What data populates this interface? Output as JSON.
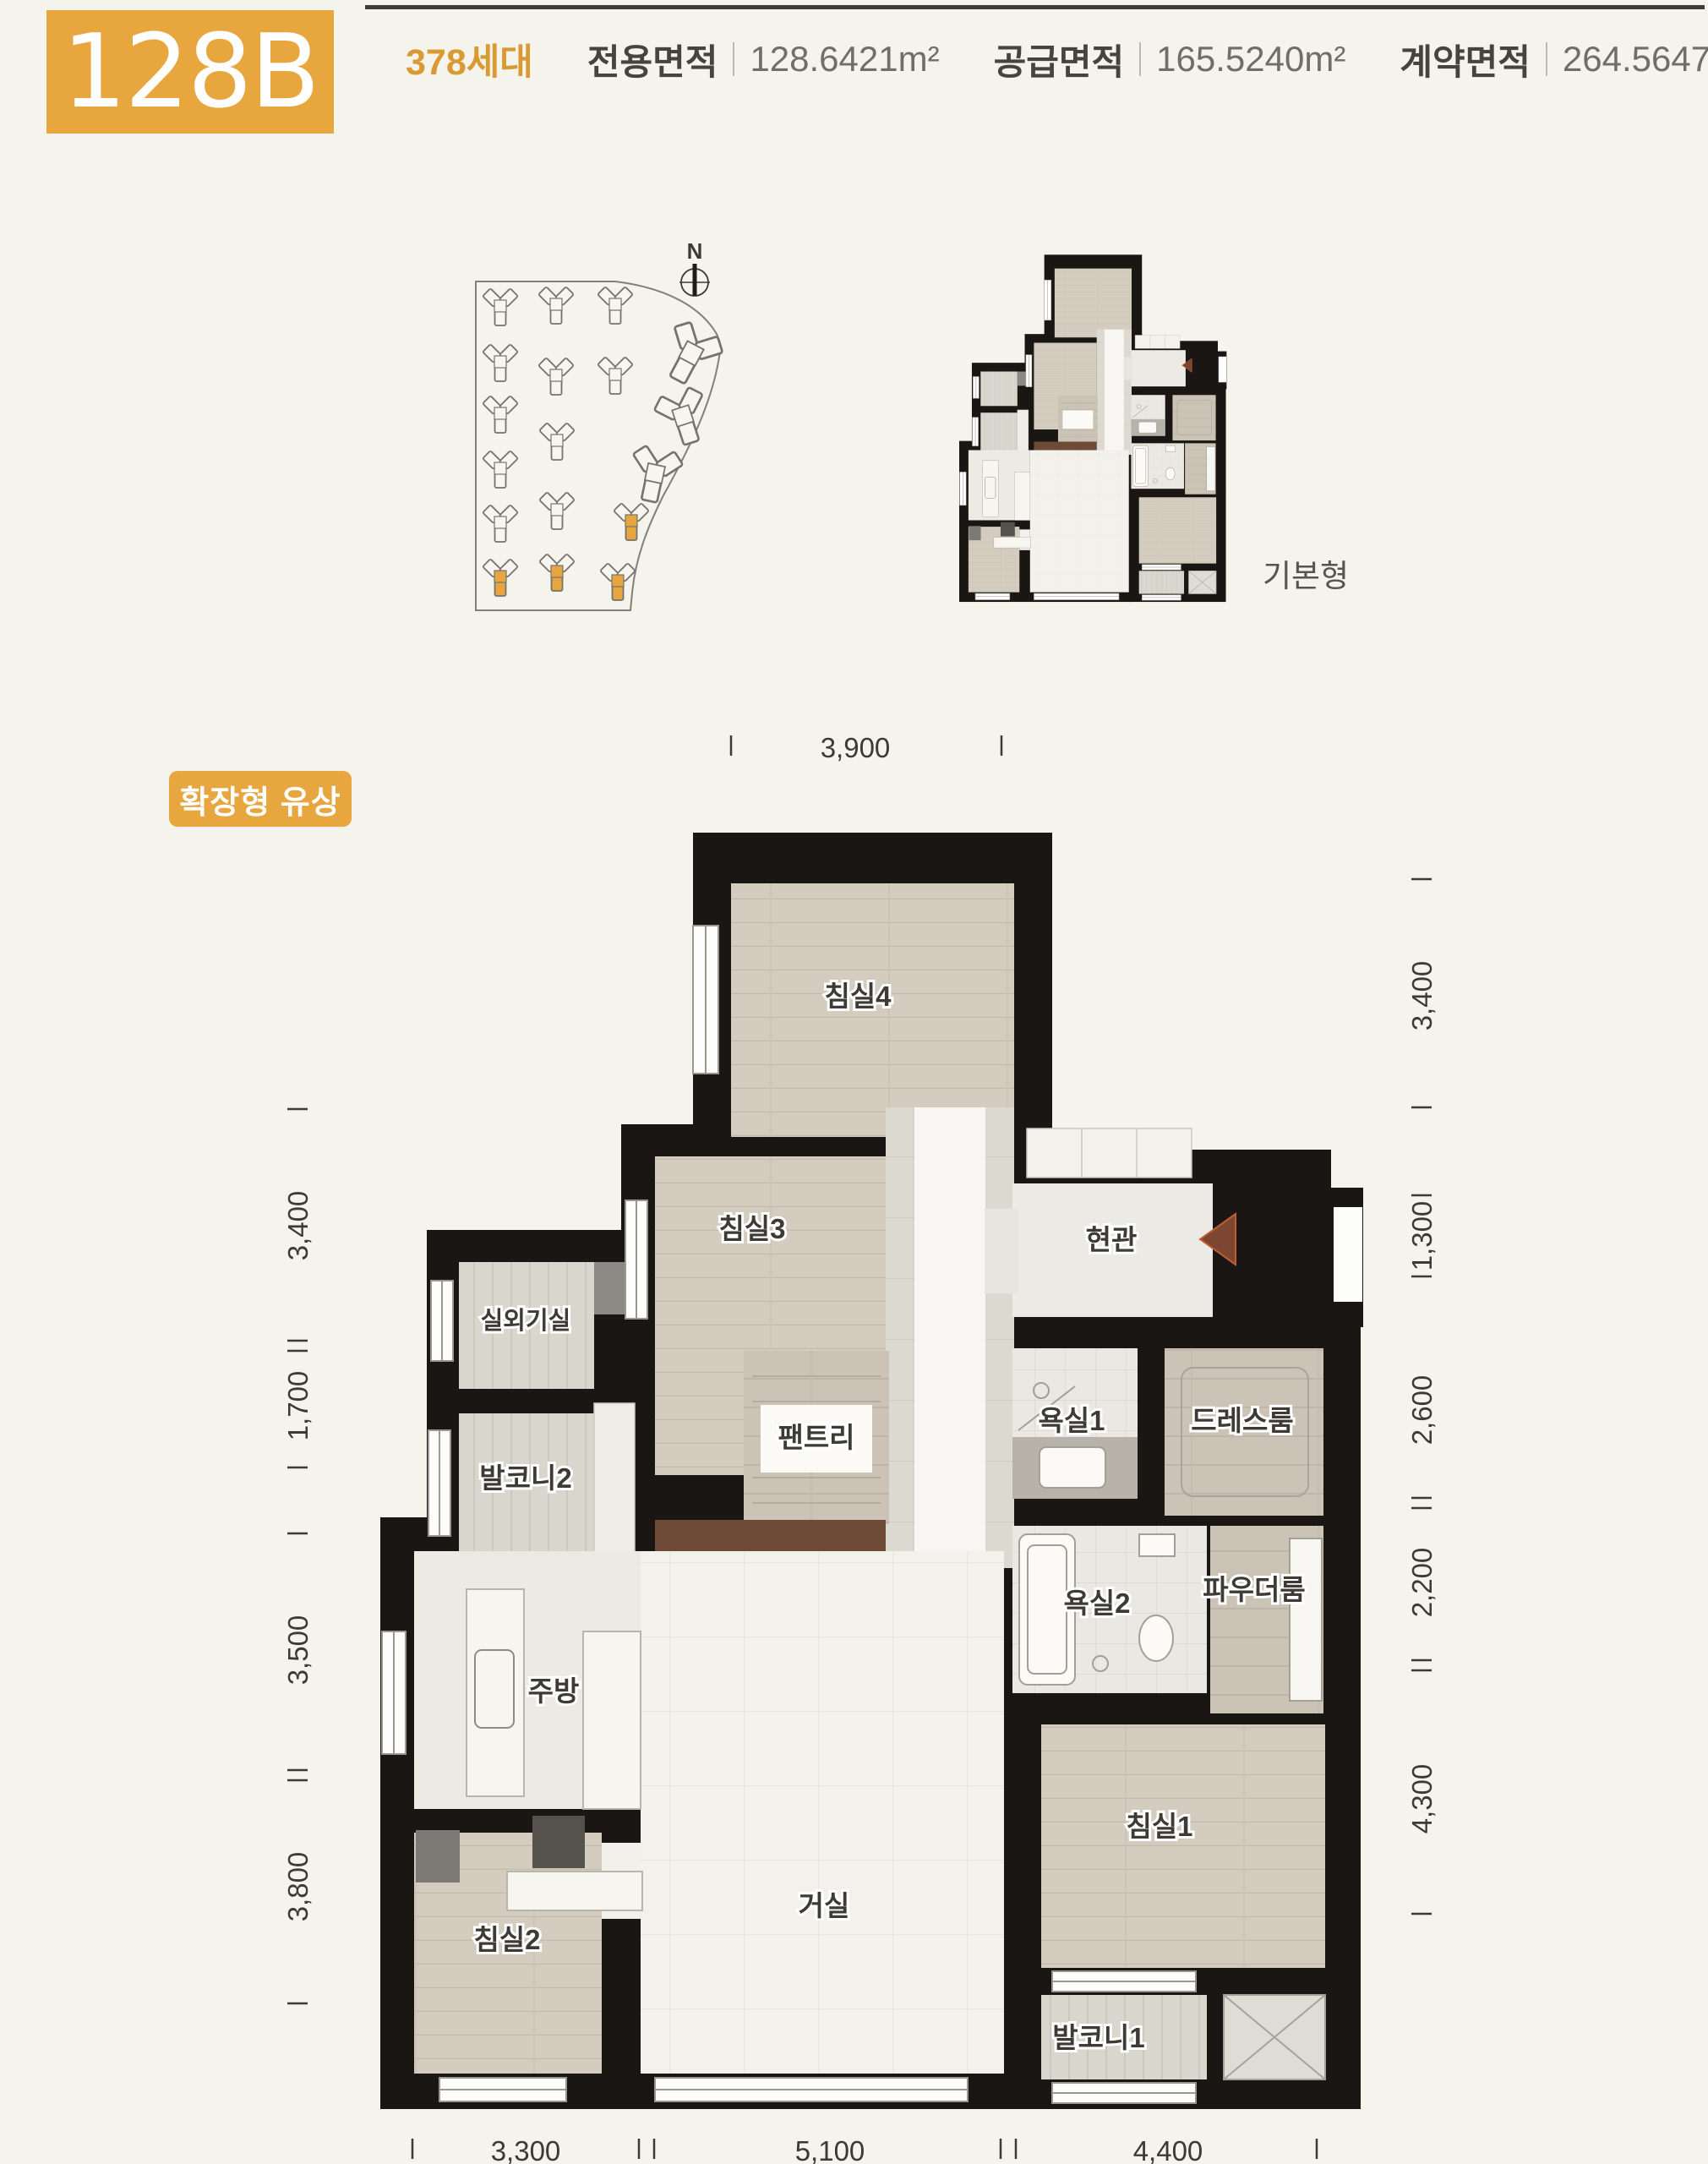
{
  "header": {
    "unit_code": "128B",
    "households": "378세대",
    "areas": [
      {
        "label": "전용면적",
        "value": "128.6421m²"
      },
      {
        "label": "공급면적",
        "value": "165.5240m²"
      },
      {
        "label": "계약면적",
        "value": "264.5647m²"
      }
    ]
  },
  "site_plan": {
    "north_label": "N"
  },
  "mini_plan": {
    "label": "기본형"
  },
  "main_plan": {
    "badge": "확장형 유상",
    "rooms": {
      "bedroom4": "침실4",
      "bedroom3": "침실3",
      "entrance": "현관",
      "ac_room": "실외기실",
      "balcony2": "발코니2",
      "pantry": "팬트리",
      "bath1": "욕실1",
      "dressroom": "드레스룸",
      "bath2": "욕실2",
      "powder": "파우더룸",
      "kitchen": "주방",
      "living": "거실",
      "bedroom2": "침실2",
      "bedroom1": "침실1",
      "balcony1": "발코니1"
    },
    "dimensions": {
      "top": [
        "3,900"
      ],
      "left": [
        "3,400",
        "1,700",
        "3,500",
        "3,800"
      ],
      "right": [
        "3,400",
        "1,300",
        "2,600",
        "2,200",
        "4,300"
      ],
      "bottom": [
        "3,300",
        "5,100",
        "4,400"
      ]
    }
  },
  "colors": {
    "accent_orange": "#e8a63e",
    "wall_black": "#191613",
    "background": "#f4f3ec"
  }
}
